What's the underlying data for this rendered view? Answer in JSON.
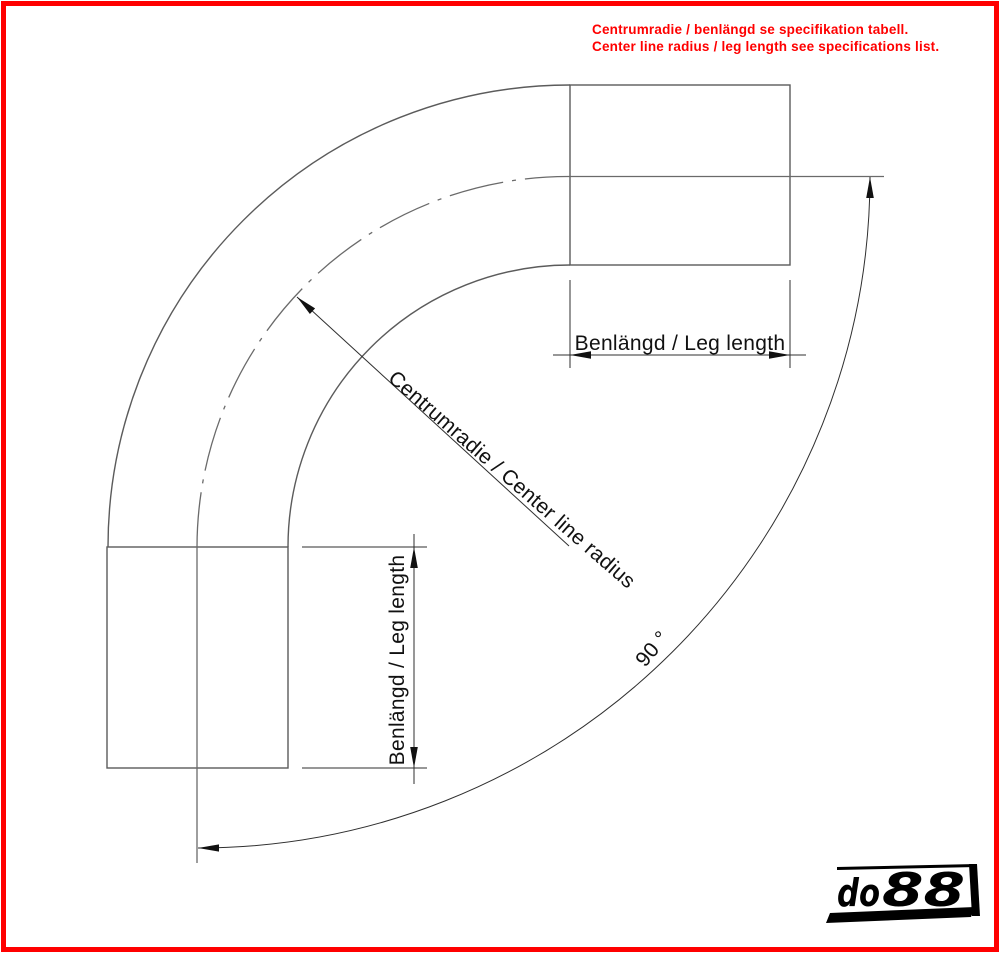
{
  "notice": {
    "line1": "Centrumradie / benlängd se specifikation tabell.",
    "line2": "Center line radius / leg length see specifications list.",
    "color": "#ff0000"
  },
  "diagram": {
    "labels": {
      "leg_length_top": "Benlängd / Leg length",
      "leg_length_left": "Benlängd / Leg length",
      "center_radius": "Centrumradie / Center line radius",
      "angle": "90 °"
    }
  },
  "logo": {
    "prefix": "do",
    "digits": "88",
    "color": "#000000"
  },
  "colors": {
    "frame": "#ff0000",
    "drawing_lines": "#5b5b5b",
    "dimension_lines": "#2f2f2f",
    "text": "#111111"
  }
}
